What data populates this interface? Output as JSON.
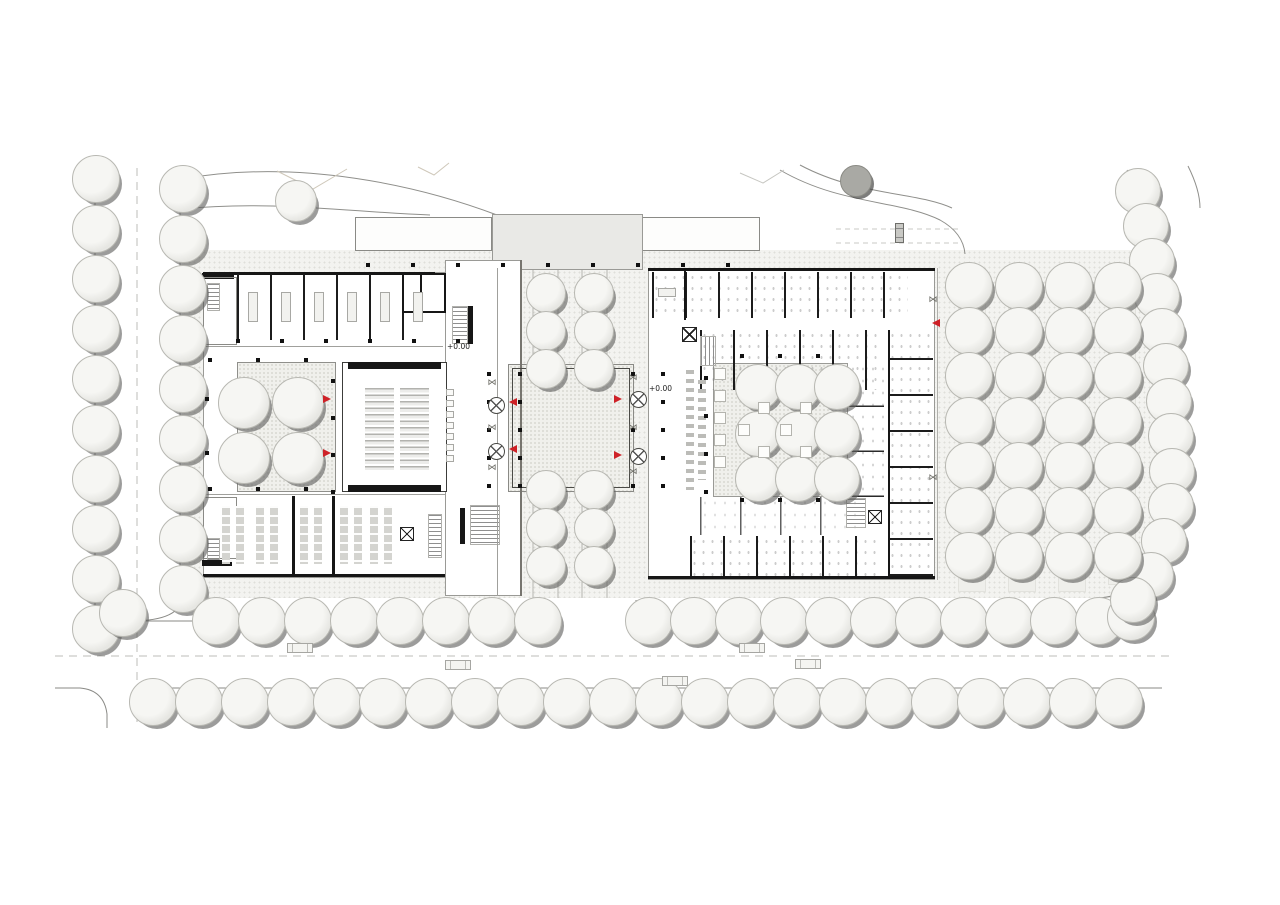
{
  "plan": {
    "title": "ground-floor site plan",
    "colors": {
      "accent_red": "#ce2127",
      "wall_black": "#161616",
      "paving": "#f3f3f0",
      "line_gray": "#8a8a86",
      "tree_shadow": "#606060"
    },
    "labels": [
      {
        "text": "+0.00",
        "x": 447,
        "y": 346
      },
      {
        "text": "+0.00",
        "x": 649,
        "y": 388
      }
    ],
    "trees": {
      "groups": [
        {
          "name": "street-left-outer",
          "size": 46,
          "col": {
            "x": 95,
            "y": 178,
            "dy": 50,
            "n": 10
          }
        },
        {
          "name": "street-left-inner",
          "size": 46,
          "col": {
            "x": 182,
            "y": 188,
            "dy": 50,
            "n": 9
          }
        },
        {
          "name": "corner-sw",
          "size": 46,
          "points": [
            [
              122,
              612
            ]
          ]
        },
        {
          "name": "road-upper-west",
          "size": 46,
          "row": {
            "x": 215,
            "y": 620,
            "dx": 46,
            "n": 8
          }
        },
        {
          "name": "road-upper-east",
          "size": 46,
          "row": {
            "x": 648,
            "y": 620,
            "dx": 45,
            "n": 11
          }
        },
        {
          "name": "road-upper-end",
          "size": 46,
          "points": [
            [
              1130,
              616
            ]
          ]
        },
        {
          "name": "road-lower",
          "size": 46,
          "row": {
            "x": 152,
            "y": 701,
            "dx": 46,
            "n": 22
          }
        },
        {
          "name": "boundary-diagonal",
          "size": 44,
          "points": [
            [
              1137,
              190
            ],
            [
              1145,
              225
            ],
            [
              1151,
              260
            ],
            [
              1156,
              295
            ],
            [
              1161,
              330
            ],
            [
              1165,
              365
            ],
            [
              1168,
              400
            ],
            [
              1170,
              435
            ],
            [
              1171,
              470
            ],
            [
              1170,
              505
            ],
            [
              1163,
              540
            ],
            [
              1150,
              574
            ],
            [
              1132,
              599
            ]
          ]
        },
        {
          "name": "lawn-tree",
          "size": 40,
          "points": [
            [
              295,
              200
            ]
          ]
        },
        {
          "name": "axis-allee",
          "size": 38,
          "points": [
            [
              545,
              292
            ],
            [
              593,
              292
            ],
            [
              545,
              330
            ],
            [
              593,
              330
            ],
            [
              545,
              368
            ],
            [
              593,
              368
            ],
            [
              545,
              489
            ],
            [
              593,
              489
            ],
            [
              545,
              527
            ],
            [
              593,
              527
            ],
            [
              545,
              565
            ],
            [
              593,
              565
            ]
          ]
        },
        {
          "name": "courtyard-left",
          "size": 50,
          "points": [
            [
              243,
              402
            ],
            [
              297,
              402
            ],
            [
              243,
              457
            ],
            [
              297,
              457
            ]
          ]
        },
        {
          "name": "courtyard-right",
          "size": 44,
          "points": [
            [
              757,
              386
            ],
            [
              797,
              386
            ],
            [
              836,
              386
            ],
            [
              757,
              433
            ],
            [
              797,
              433
            ],
            [
              836,
              433
            ],
            [
              757,
              478
            ],
            [
              797,
              478
            ],
            [
              836,
              478
            ]
          ]
        },
        {
          "name": "parking-col-1",
          "size": 46,
          "col": {
            "x": 968,
            "y": 285,
            "dy": 45,
            "n": 7
          }
        },
        {
          "name": "parking-col-2",
          "size": 46,
          "col": {
            "x": 1018,
            "y": 285,
            "dy": 45,
            "n": 7
          }
        },
        {
          "name": "parking-col-3",
          "size": 46,
          "col": {
            "x": 1068,
            "y": 285,
            "dy": 45,
            "n": 7
          }
        },
        {
          "name": "parking-col-4",
          "size": 46,
          "col": {
            "x": 1117,
            "y": 285,
            "dy": 45,
            "n": 7
          }
        },
        {
          "name": "shrub",
          "size": 30,
          "dark": true,
          "points": [
            [
              855,
              180
            ]
          ]
        }
      ]
    },
    "columns": {
      "groups": [
        {
          "row": {
            "x": 238,
            "y": 341,
            "dx": 44,
            "n": 6
          }
        },
        {
          "row": {
            "x": 368,
            "y": 265,
            "dx": 45,
            "n": 9
          }
        },
        {
          "row": {
            "x": 210,
            "y": 360,
            "dx": 48,
            "n": 3
          }
        },
        {
          "row": {
            "x": 210,
            "y": 489,
            "dx": 48,
            "n": 3
          }
        },
        {
          "col": {
            "x": 333,
            "y": 381,
            "dy": 37,
            "n": 4
          }
        },
        {
          "col": {
            "x": 207,
            "y": 399,
            "dy": 54,
            "n": 2
          }
        },
        {
          "col": {
            "x": 489,
            "y": 374,
            "dy": 28,
            "n": 5
          }
        },
        {
          "col": {
            "x": 520,
            "y": 374,
            "dy": 28,
            "n": 5
          }
        },
        {
          "col": {
            "x": 633,
            "y": 374,
            "dy": 28,
            "n": 5
          }
        },
        {
          "col": {
            "x": 663,
            "y": 374,
            "dy": 28,
            "n": 5
          }
        },
        {
          "col": {
            "x": 706,
            "y": 378,
            "dy": 38,
            "n": 4
          }
        },
        {
          "row": {
            "x": 742,
            "y": 500,
            "dx": 38,
            "n": 3
          }
        },
        {
          "row": {
            "x": 742,
            "y": 356,
            "dx": 38,
            "n": 3
          }
        }
      ]
    },
    "seminar_tables": {
      "row": {
        "x": 253,
        "y": 292,
        "dx": 33,
        "n": 6
      },
      "w": 10,
      "h": 30
    },
    "aud_side_boxes": {
      "col": {
        "x": 450,
        "y": 392,
        "dy": 11,
        "n": 7
      },
      "w": 8,
      "h": 7
    },
    "court_planters": {
      "points": [
        [
          720,
          374
        ],
        [
          720,
          396
        ],
        [
          720,
          418
        ],
        [
          720,
          440
        ],
        [
          720,
          462
        ],
        [
          764,
          408
        ],
        [
          764,
          452
        ],
        [
          806,
          408
        ],
        [
          806,
          452
        ],
        [
          744,
          430
        ],
        [
          786,
          430
        ]
      ],
      "w": 12,
      "h": 12
    },
    "circle_fixtures": [
      [
        495,
        404
      ],
      [
        495,
        450
      ],
      [
        637,
        398
      ],
      [
        637,
        455
      ]
    ],
    "shade_marks": [
      [
        492,
        383
      ],
      [
        492,
        428
      ],
      [
        492,
        468
      ],
      [
        633,
        378
      ],
      [
        633,
        428
      ],
      [
        633,
        472
      ],
      [
        933,
        300
      ],
      [
        933,
        478
      ]
    ],
    "cars": [
      {
        "x": 300,
        "y": 648,
        "o": "h"
      },
      {
        "x": 458,
        "y": 665,
        "o": "h"
      },
      {
        "x": 675,
        "y": 681,
        "o": "h"
      },
      {
        "x": 752,
        "y": 648,
        "o": "h"
      },
      {
        "x": 808,
        "y": 664,
        "o": "h"
      },
      {
        "x": 899,
        "y": 233,
        "o": "v"
      }
    ],
    "entry_arrows": [
      {
        "x": 327,
        "y": 399,
        "dir": "r"
      },
      {
        "x": 327,
        "y": 453,
        "dir": "r"
      },
      {
        "x": 513,
        "y": 402,
        "dir": "l"
      },
      {
        "x": 513,
        "y": 449,
        "dir": "l"
      },
      {
        "x": 618,
        "y": 399,
        "dir": "r"
      },
      {
        "x": 618,
        "y": 455,
        "dir": "r"
      },
      {
        "x": 936,
        "y": 323,
        "dir": "l"
      }
    ]
  }
}
